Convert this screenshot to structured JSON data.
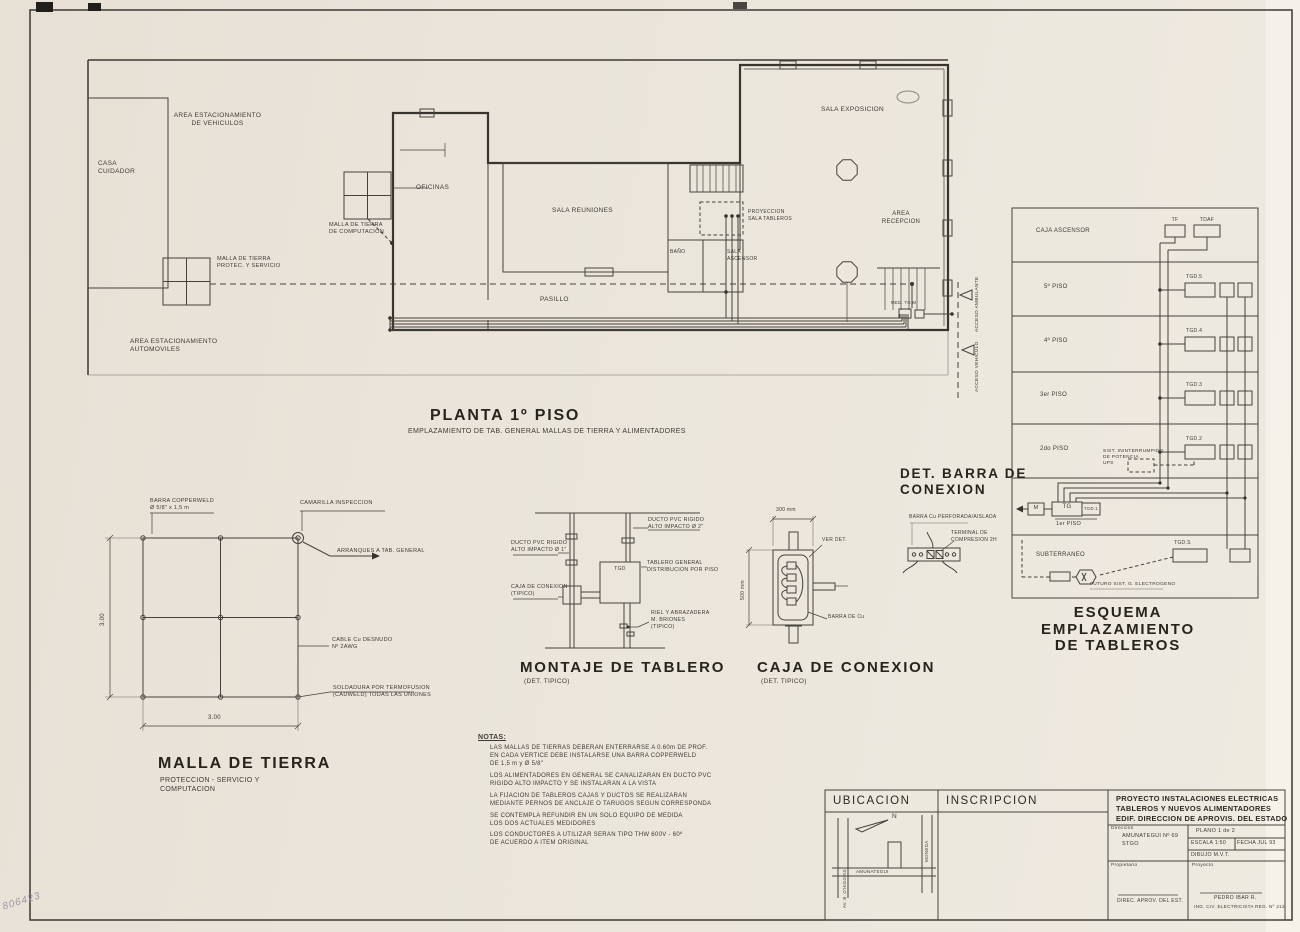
{
  "colors": {
    "paper": "#e9e3da",
    "ink": "#3e3b35"
  },
  "sheet": {
    "stamp": "806423"
  },
  "plan": {
    "title": "PLANTA 1º PISO",
    "subtitle": "EMPLAZAMIENTO DE TAB. GENERAL MALLAS DE TIERRA  Y ALIMENTADORES",
    "labels": {
      "area_vehiculos": "AREA ESTACIONAMIENTO\nDE VEHICULOS",
      "casa_cuidador": "CASA\nCUIDADOR",
      "area_automoviles": "AREA ESTACIONAMIENTO\nAUTOMOVILES",
      "malla_servicio": "MALLA DE TIERRA\nPROTEC. Y SERVICIO",
      "malla_computacion": "MALLA DE TIERRA\nDE COMPUTACION",
      "oficinas": "OFICINAS",
      "sala_reuniones": "SALA  REUNIONES",
      "pasillo": "PASILLO",
      "bano": "BAÑO",
      "sala_ascensor": "SALA\nASCENSOR",
      "proyeccion": "PROYECCION\nSALA TABLEROS",
      "sala_exposicion": "SALA  EXPOSICION",
      "area_recepcion": "AREA\nRECEPCION",
      "medidor": "MED. TG  M",
      "acceso_ambulante": "ACCESO AMBULANTE",
      "acceso_vehiculo": "ACCESO VEHICULO"
    }
  },
  "malla_detail": {
    "barra_copperweld": "BARRA COPPERWELD\nØ 5/8\" x 1,5 m",
    "camarilla": "CAMARILLA INSPECCION",
    "arranques": "ARRANQUES A TAB. GENERAL",
    "cable": "CABLE Cu DESNUDO\nNº 2AWG",
    "soldadura": "SOLDADURA POR TERMOFUSION\n(CADWELD) TODAS LAS UNIONES",
    "dim_width": "3.00",
    "dim_height": "3.00",
    "title": "MALLA DE TIERRA",
    "subtitle": "PROTECCION - SERVICIO  Y\nCOMPUTACION"
  },
  "montaje_detail": {
    "ducto_1": "DUCTO PVC RIGIDO\nALTO IMPACTO Ø 1\"",
    "ducto_2": "DUCTO PVC RIGIDO\nALTO IMPACTO Ø 2\"",
    "tgd": "TGD",
    "tablero_general": "TABLERO GENERAL\nDISTRIBUCION POR PISO",
    "caja_conexion": "CAJA DE CONEXION\n(TIPICO)",
    "riel": "RIEL Y ABRAZADERA\nM. BRIONES\n(TIPICO)",
    "title": "MONTAJE DE TABLERO",
    "subtitle": "(DET. TIPICO)"
  },
  "caja_detail": {
    "dim_width": "300 mm",
    "dim_height": "500 mm",
    "ver_det": "VER DET.",
    "barra_cu": "BARRA DE Cu",
    "title": "CAJA  DE CONEXION",
    "subtitle": "(DET. TIPICO)"
  },
  "barra_detail": {
    "title": "DET. BARRA DE\nCONEXION",
    "barra": "BARRA Cu PERFORADA/AISLADA",
    "terminal": "TERMINAL DE\nCOMPRESION 2H"
  },
  "esquema": {
    "title": "ESQUEMA EMPLAZAMIENTO\nDE TABLEROS",
    "tf": "TF",
    "tdaf": "TDAF",
    "m": "M",
    "tg": "TG",
    "tgd1": "TGD.1",
    "tgds": "TGD.S",
    "ups": "SIST. ININTERRUMPIDO\nDE POTENCIA\nUPS",
    "futuro": "FUTURO SIST. G. ELECTROGENO",
    "floors": [
      {
        "label": "CAJA ASCENSOR"
      },
      {
        "label": "5º PISO",
        "box": "TGD.5"
      },
      {
        "label": "4º PISO",
        "box": "TGD.4"
      },
      {
        "label": "3er PISO",
        "box": "TGD.3"
      },
      {
        "label": "2do PISO",
        "box": "TGD.2"
      },
      {
        "label": "1er PISO"
      },
      {
        "label": "SUBTERRANEO"
      }
    ]
  },
  "notas": {
    "title": "NOTAS:",
    "items": [
      "LAS MALLAS DE TIERRAS DEBERAN ENTERRARSE A 0.60m DE PROF.\nEN CADA VERTICE DEBE INSTALARSE UNA BARRA COPPERWELD\nDE 1,5 m y Ø 5/8\"",
      "LOS ALIMENTADORES EN GENERAL SE CANALIZARAN EN DUCTO PVC\nRIGIDO ALTO IMPACTO Y SE INSTALARAN A LA VISTA",
      "LA FIJACION DE TABLEROS CAJAS Y DUCTOS SE REALIZARAN\nMEDIANTE PERNOS DE ANCLAJE O TARUGOS SEGUN CORRESPONDA",
      "SE CONTEMPLA REFUNDIR EN UN SOLO EQUIPO DE MEDIDA\nLOS DOS ACTUALES MEDIDORES",
      "LOS CONDUCTORES A UTILIZAR SERAN TIPO THW 600V - 60º\nDE ACUERDO A ITEM ORIGINAL"
    ]
  },
  "ubicacion": {
    "title": "UBICACION",
    "inscripcion_title": "INSCRIPCION",
    "north": "N",
    "street_left": "AV. B. O'HIGGINS",
    "street_bottom": "AMUNATEGUI",
    "street_right": "MONEDA"
  },
  "titleblock": {
    "project": "PROYECTO INSTALACIONES ELECTRICAS\nTABLEROS Y NUEVOS ALIMENTADORES\nEDIF. DIRECCION DE APROVIS. DEL ESTADO",
    "direccion_label": "Direccion",
    "direccion_value": "AMUNATEGUI Nº 69\nSTGO",
    "plano": "PLANO  1  de  2",
    "escala": "ESCALA 1:50",
    "fecha": "FECHA JUL 93",
    "dibujo": "DIBUJO  M.V.T.",
    "propietario_label": "Propietario",
    "propietario_value": "DIREC. APROV. DEL EST.",
    "proyecto_label": "Proyecto",
    "proyecto_name": "PEDRO IBAR R.",
    "proyecto_title": "ING. CIV. ELECTRICISTA  REG. Nº 212"
  }
}
